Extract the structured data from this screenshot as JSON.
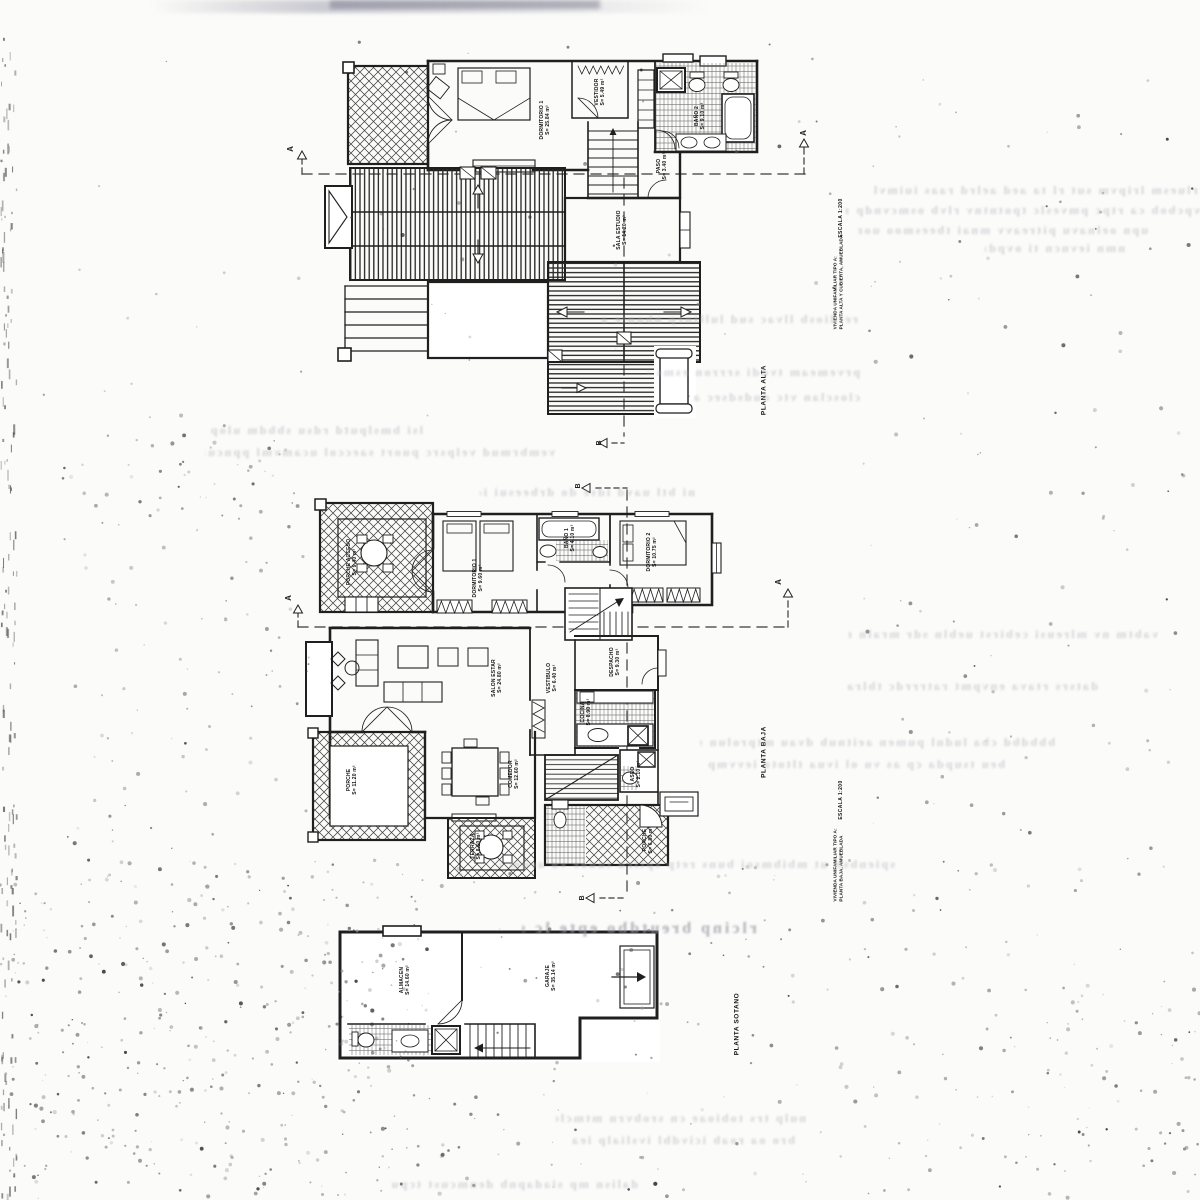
{
  "markers": {
    "section_a": "A",
    "section_b": "B"
  },
  "plans": {
    "alta": {
      "floor_label": "PLANTA ALTA",
      "scale_label": "ESCALA 1:200",
      "title_line1": "VIVIENDA UNIFAMILIAR TIPO A:",
      "title_line2": "PLANTA ALTA Y CUBIERTA, AMUEBLADA",
      "rooms": [
        {
          "name": "DORMITORIO 1",
          "area": "S= 25.84 m²"
        },
        {
          "name": "VESTIDOR",
          "area": "S= 5.49 m²"
        },
        {
          "name": "BAÑO 2",
          "area": "S= 9.10 m²"
        },
        {
          "name": "PASO",
          "area": "S= 3.40 m²"
        },
        {
          "name": "SALA ESTUDIO",
          "area": "S= 14.20 m²"
        }
      ]
    },
    "baja": {
      "floor_label": "PLANTA BAJA",
      "scale_label": "ESCALA 1:200",
      "title_line1": "VIVIENDA UNIFAMILIAR TIPO A:",
      "title_line2": "PLANTA BAJA, AMUEBLADA",
      "rooms": [
        {
          "name": "PORCHE ACCESO",
          "area": "S= 9.40 m²"
        },
        {
          "name": "DORMITORIO 1",
          "area": "S= 9.60 m²"
        },
        {
          "name": "BAÑO 1",
          "area": "S= 4.10 m²"
        },
        {
          "name": "DORMITORIO 2",
          "area": "S= 10.75 m²"
        },
        {
          "name": "SALON ESTAR",
          "area": "S= 24.80 m²"
        },
        {
          "name": "VESTIBULO",
          "area": "S= 6.40 m²"
        },
        {
          "name": "DESPACHO",
          "area": "S= 9.30 m²"
        },
        {
          "name": "COCINA",
          "area": "S= 8.90 m²"
        },
        {
          "name": "COMEDOR",
          "area": "S= 12.60 m²"
        },
        {
          "name": "PORCHE",
          "area": "S= 11.20 m²"
        },
        {
          "name": "TERRAZA",
          "area": "S= 8.60 m²"
        },
        {
          "name": "ASEO",
          "area": "S= 2.10 m²"
        },
        {
          "name": "PORCHE",
          "area": "S= 6.80 m²"
        }
      ]
    },
    "sotano": {
      "floor_label": "PLANTA SOTANO",
      "rooms": [
        {
          "name": "ALMACEN",
          "area": "S= 14.60 m²"
        },
        {
          "name": "GARAJE",
          "area": "S= 35.14 m²"
        }
      ]
    }
  }
}
